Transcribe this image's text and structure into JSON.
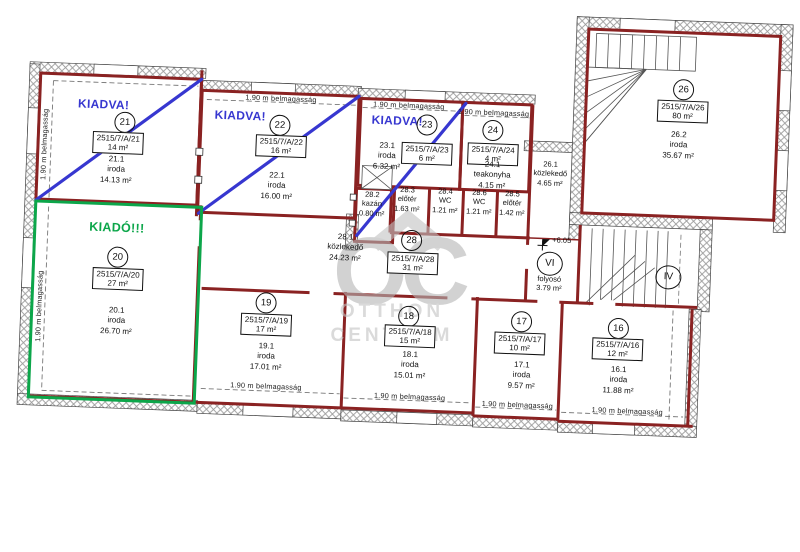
{
  "watermark": {
    "monogram": "OC",
    "word1": "OTTHON",
    "word2": "CENTRUM"
  },
  "shared": {
    "ceiling": "1.90 m belmagasság",
    "level": "+6.05"
  },
  "status": {
    "rented": "KIADVA!",
    "available": "KIADÓ!!!"
  },
  "colors": {
    "wall": "#8a2222",
    "rented_line": "#3737d0",
    "available_line": "#0ca64a",
    "hatch": "#9b9b9b",
    "watermark": "#b5b5b5"
  },
  "rooms": {
    "r16": {
      "no": "16",
      "lot": "2515/7/A/16",
      "lot_area": "12 m²",
      "unit": "16.1",
      "use": "iroda",
      "area": "11.88 m²"
    },
    "r17": {
      "no": "17",
      "lot": "2515/7/A/17",
      "lot_area": "10 m²",
      "unit": "17.1",
      "use": "iroda",
      "area": "9.57 m²"
    },
    "r18": {
      "no": "18",
      "lot": "2515/7/A/18",
      "lot_area": "15 m²",
      "unit": "18.1",
      "use": "iroda",
      "area": "15.01 m²"
    },
    "r19": {
      "no": "19",
      "lot": "2515/7/A/19",
      "lot_area": "17 m²",
      "unit": "19.1",
      "use": "iroda",
      "area": "17.01 m²"
    },
    "r20": {
      "no": "20",
      "lot": "2515/7/A/20",
      "lot_area": "27 m²",
      "unit": "20.1",
      "use": "iroda",
      "area": "26.70 m²"
    },
    "r21": {
      "no": "21",
      "lot": "2515/7/A/21",
      "lot_area": "14 m²",
      "unit": "21.1",
      "use": "iroda",
      "area": "14.13 m²"
    },
    "r22": {
      "no": "22",
      "lot": "2515/7/A/22",
      "lot_area": "16 m²",
      "unit": "22.1",
      "use": "iroda",
      "area": "16.00 m²"
    },
    "r23": {
      "no": "23",
      "lot": "2515/7/A/23",
      "lot_area": "6 m²",
      "unit": "23.1",
      "use": "iroda",
      "area": "6.32 m²"
    },
    "r24": {
      "no": "24",
      "lot": "2515/7/A/24",
      "lot_area": "4 m²",
      "unit": "24.1",
      "use": "teakonyha",
      "area": "4.15 m²"
    },
    "r26": {
      "no": "26",
      "lot": "2515/7/A/26",
      "lot_area": "80 m²",
      "unit": "26.2",
      "use": "iroda",
      "area": "35.67 m²"
    },
    "r28": {
      "no": "28",
      "lot": "2515/7/A/28",
      "lot_area": "31 m²"
    }
  },
  "units": {
    "u281": {
      "unit": "28.1",
      "use": "közlekedő",
      "area": "24.23 m²"
    },
    "u282": {
      "unit": "28.2",
      "use": "kazán",
      "area": "0.80 m²"
    },
    "u283": {
      "unit": "28.3",
      "use": "előtér",
      "area": "1.63 m²"
    },
    "u284": {
      "unit": "28.4",
      "use": "WC",
      "area": "1.21 m²"
    },
    "u286": {
      "unit": "28.6",
      "use": "WC",
      "area": "1.21 m²"
    },
    "u285": {
      "unit": "28.5",
      "use": "előtér",
      "area": "1.42 m²"
    },
    "u261": {
      "unit": "26.1",
      "use": "közlekedő",
      "area": "4.65 m²"
    }
  },
  "stairs": {
    "vi": "VI",
    "vi_use": "folyosó",
    "vi_area": "3.79 m²",
    "iv": "IV"
  }
}
